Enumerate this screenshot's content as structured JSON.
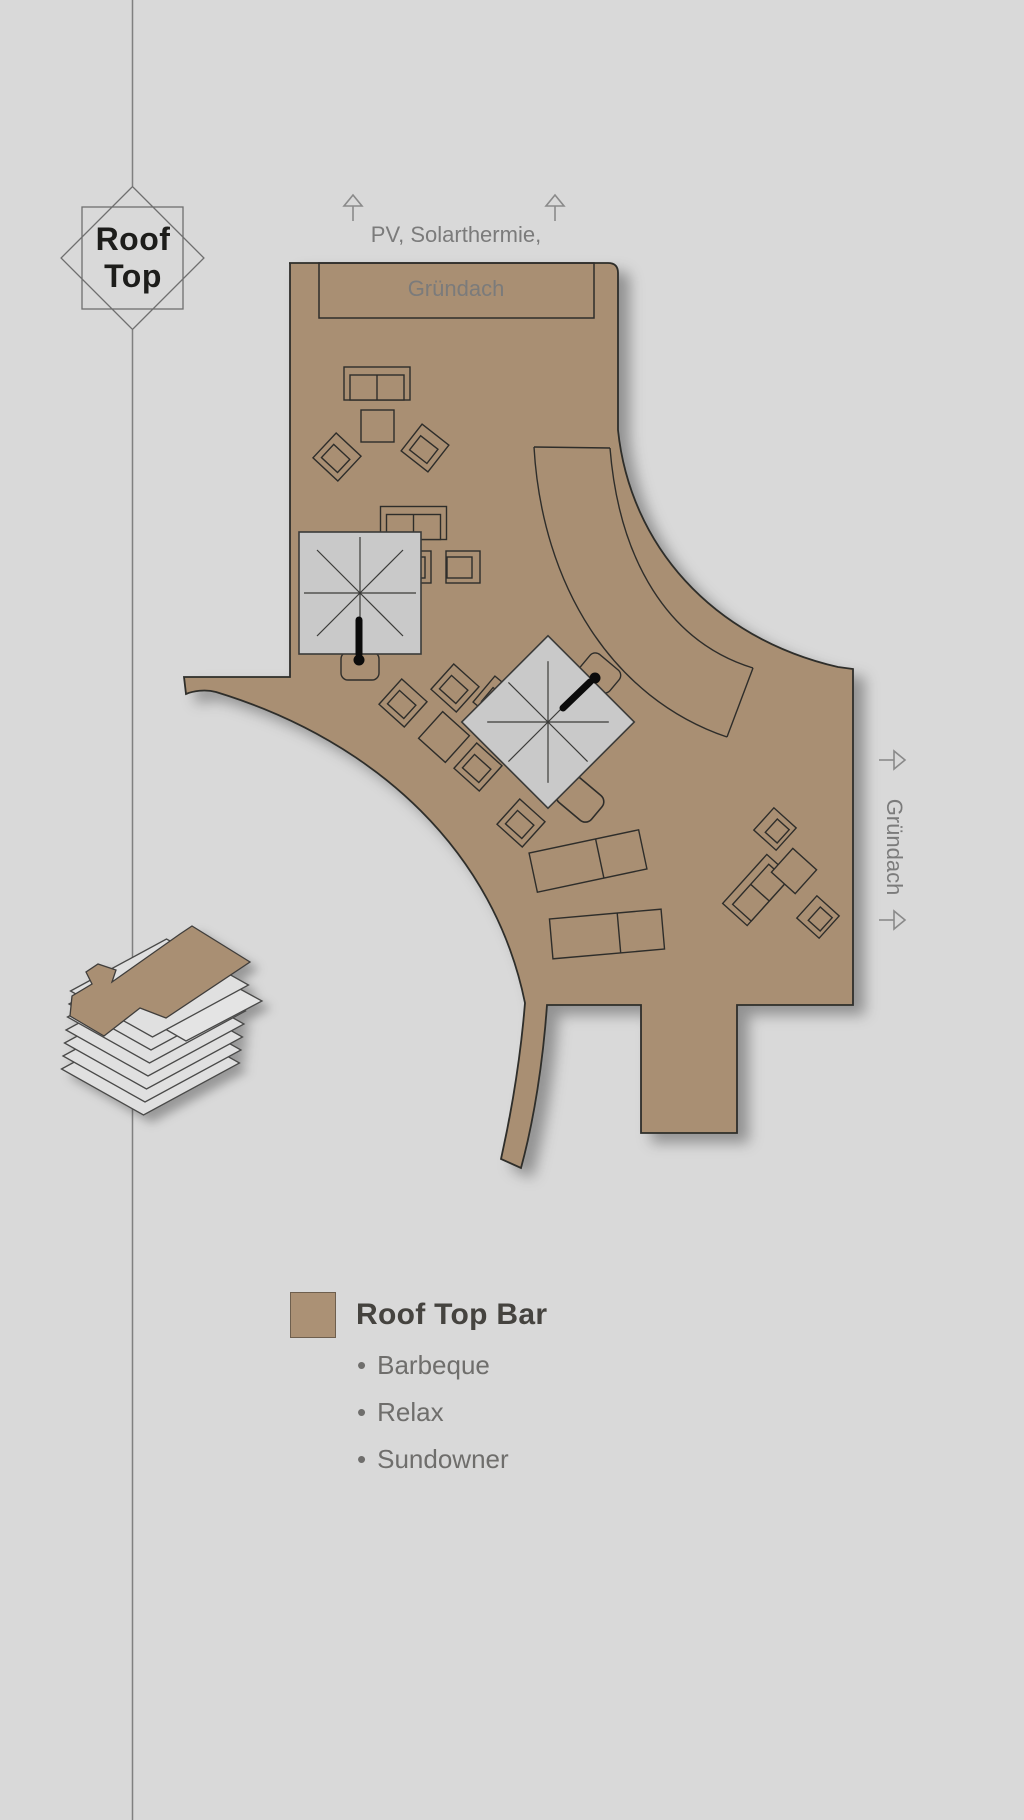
{
  "badge": {
    "line1": "Roof",
    "line2": "Top"
  },
  "top_caption": {
    "line1": "PV,  Solarthermie,",
    "line2": "Gründach"
  },
  "right_caption": {
    "label": "Gründach"
  },
  "legend": {
    "swatch_color": "#ab9175",
    "title": "Roof Top Bar",
    "bullet": "•",
    "items": [
      {
        "label": "Barbeque"
      },
      {
        "label": "Relax"
      },
      {
        "label": "Sundowner"
      }
    ]
  },
  "colors": {
    "background": "#d9d9d9",
    "roof_fill": "#a98f73",
    "outline": "#2e2d2a",
    "umbrella_fill": "#c9c9c9",
    "section_line": "#808080",
    "caption_gray": "#7b7b7b",
    "legend_title": "#45433f",
    "legend_item": "#6f6e6c"
  }
}
